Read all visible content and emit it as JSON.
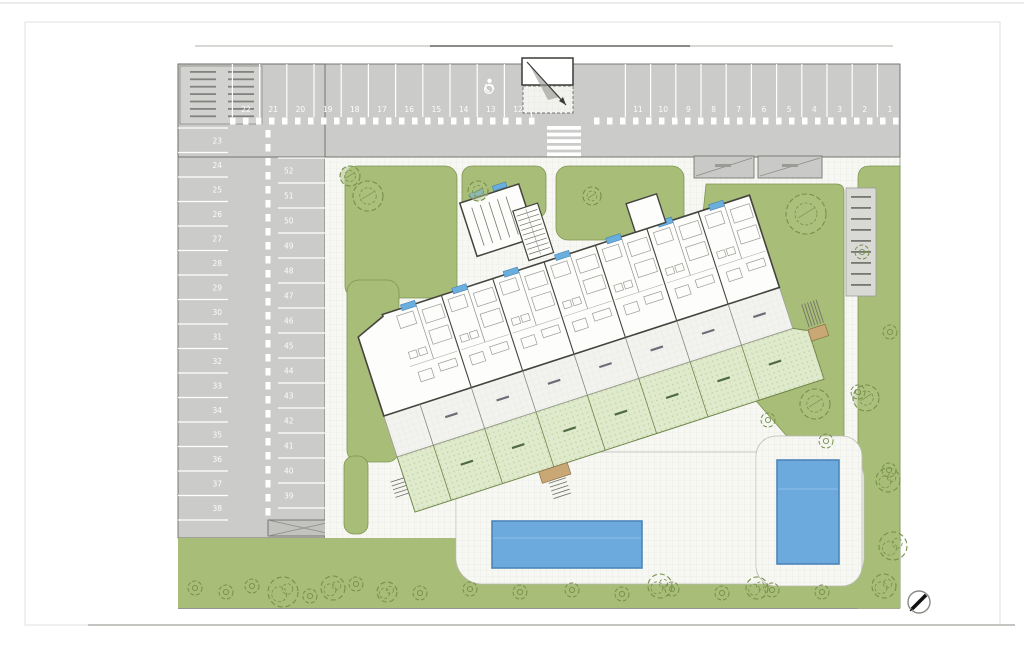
{
  "colors": {
    "lawn": "#a8bd77",
    "lawn_edge": "#7f9752",
    "paving": "#f7f7f3",
    "grid_line": "#e4e4df",
    "parking_gray": "#cbcbca",
    "stall_line": "#ffffff",
    "garden": "#dfe9cc",
    "garden_dot": "#b9cf97",
    "pool_fill": "#6ca9dd",
    "pool_edge": "#4d86ba",
    "wall": "#44443e",
    "tree": "#74904a",
    "window_blue": "#6aaede"
  },
  "parking": {
    "top_row_left": [
      "22",
      "21",
      "20",
      "19",
      "18",
      "17",
      "16",
      "15",
      "14",
      "13",
      "12"
    ],
    "top_row_right": [
      "11",
      "10",
      "9",
      "8",
      "7",
      "6",
      "5",
      "4",
      "3",
      "2",
      "1"
    ],
    "west_column": [
      "23",
      "24",
      "25",
      "26",
      "27",
      "28",
      "29",
      "30",
      "31",
      "32",
      "33",
      "34",
      "35",
      "36",
      "37",
      "38"
    ],
    "east_column": [
      "52",
      "51",
      "50",
      "49",
      "48",
      "47",
      "46",
      "45",
      "44",
      "43",
      "42",
      "41",
      "40",
      "39"
    ]
  },
  "building": {
    "unit_count": 7
  },
  "legend": {
    "rows": 7,
    "columns": 2
  },
  "landscape": {
    "trees": [
      [
        350,
        176,
        10
      ],
      [
        368,
        196,
        15
      ],
      [
        478,
        191,
        10
      ],
      [
        592,
        196,
        9
      ],
      [
        806,
        214,
        20
      ],
      [
        815,
        404,
        15
      ],
      [
        866,
        398,
        13
      ]
    ],
    "bushes_small": [
      [
        195,
        588
      ],
      [
        226,
        592
      ],
      [
        252,
        586
      ],
      [
        310,
        596
      ],
      [
        356,
        584
      ],
      [
        420,
        593
      ],
      [
        470,
        589
      ],
      [
        520,
        592
      ],
      [
        572,
        590
      ],
      [
        622,
        594
      ],
      [
        672,
        589
      ],
      [
        722,
        593
      ],
      [
        772,
        590
      ],
      [
        822,
        592
      ],
      [
        862,
        252
      ],
      [
        890,
        332
      ],
      [
        858,
        392
      ],
      [
        826,
        441
      ],
      [
        889,
        470
      ],
      [
        768,
        420
      ]
    ],
    "bushes_big": [
      [
        283,
        592,
        15
      ],
      [
        333,
        588,
        12
      ],
      [
        387,
        592,
        10
      ],
      [
        660,
        586,
        12
      ],
      [
        757,
        588,
        11
      ],
      [
        888,
        480,
        12
      ],
      [
        893,
        546,
        14
      ],
      [
        884,
        586,
        12
      ]
    ]
  }
}
